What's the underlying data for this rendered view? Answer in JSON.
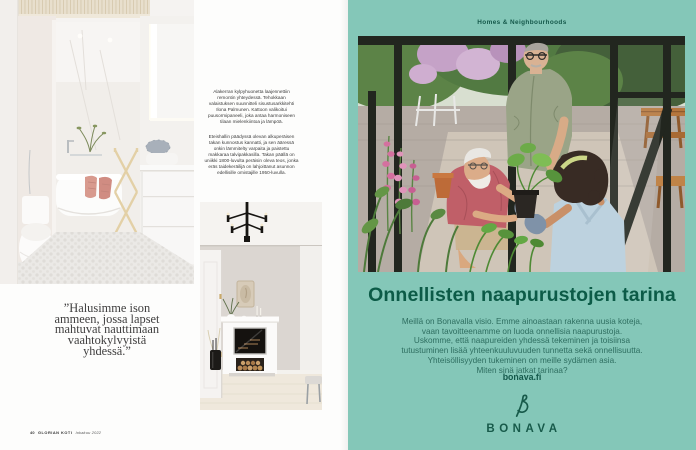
{
  "left_page": {
    "captions": [
      "Alakerran kylpyhuonetta laajennettiin remontin yhteydessä. Tehokkaan valaistuksen suunnitteli sisustusarkkitehti Ilona Palmunen. Kattoon valikoitui puusormipaneeli, joka antaa harmoniseen tilaan mielenkiintoa ja lämpöä.",
      "Eteishallin päädyssä olevan alkuperäisen takan kunnostus kannatti, ja sen ääressä onkin lämmitelty varpaita ja paistettu makkaraa talvipakkasilla. Takan päällä on uniikki 1800-luvulta peräisin oleva teos, jonka eräs taidekeräilijä on lahjoittanut asunnon edellisille omistajille 1950-luvulla."
    ],
    "quote_lines": [
      "”Halusimme ison",
      "ammeen, jossa lapset",
      "mahtuvat nauttimaan",
      "vaahtokylvyistä",
      "yhdessä.”"
    ],
    "footer": {
      "page_number": "40",
      "magazine": "GLORIAN KOTI",
      "issue": "lokakuu 2022"
    }
  },
  "right_page": {
    "kicker": "Homes & Neighbourhoods",
    "heading": "Onnellisten naapurustojen tarina",
    "body_lines": [
      "Meillä on Bonavalla visio. Emme ainoastaan rakenna uusia koteja,",
      "vaan tavoitteenamme on luoda onnellisia naapurustoja.",
      "Uskomme, että naapureiden yhdessä tekeminen ja toisiinsa",
      "tutustuminen lisää yhteenkuuluvuuden tunnetta sekä onnellisuutta.",
      "Yhteisöllisyyden tukeminen on meille sydämen asia.",
      "Miten sinä jatkat tarinaa?"
    ],
    "url": "bonava.fi",
    "brand": "BONAVA",
    "colors": {
      "background": "#84c7b8",
      "heading": "#0c5b47",
      "body_text": "#2e6e60",
      "brand_green": "#175a4a"
    }
  }
}
